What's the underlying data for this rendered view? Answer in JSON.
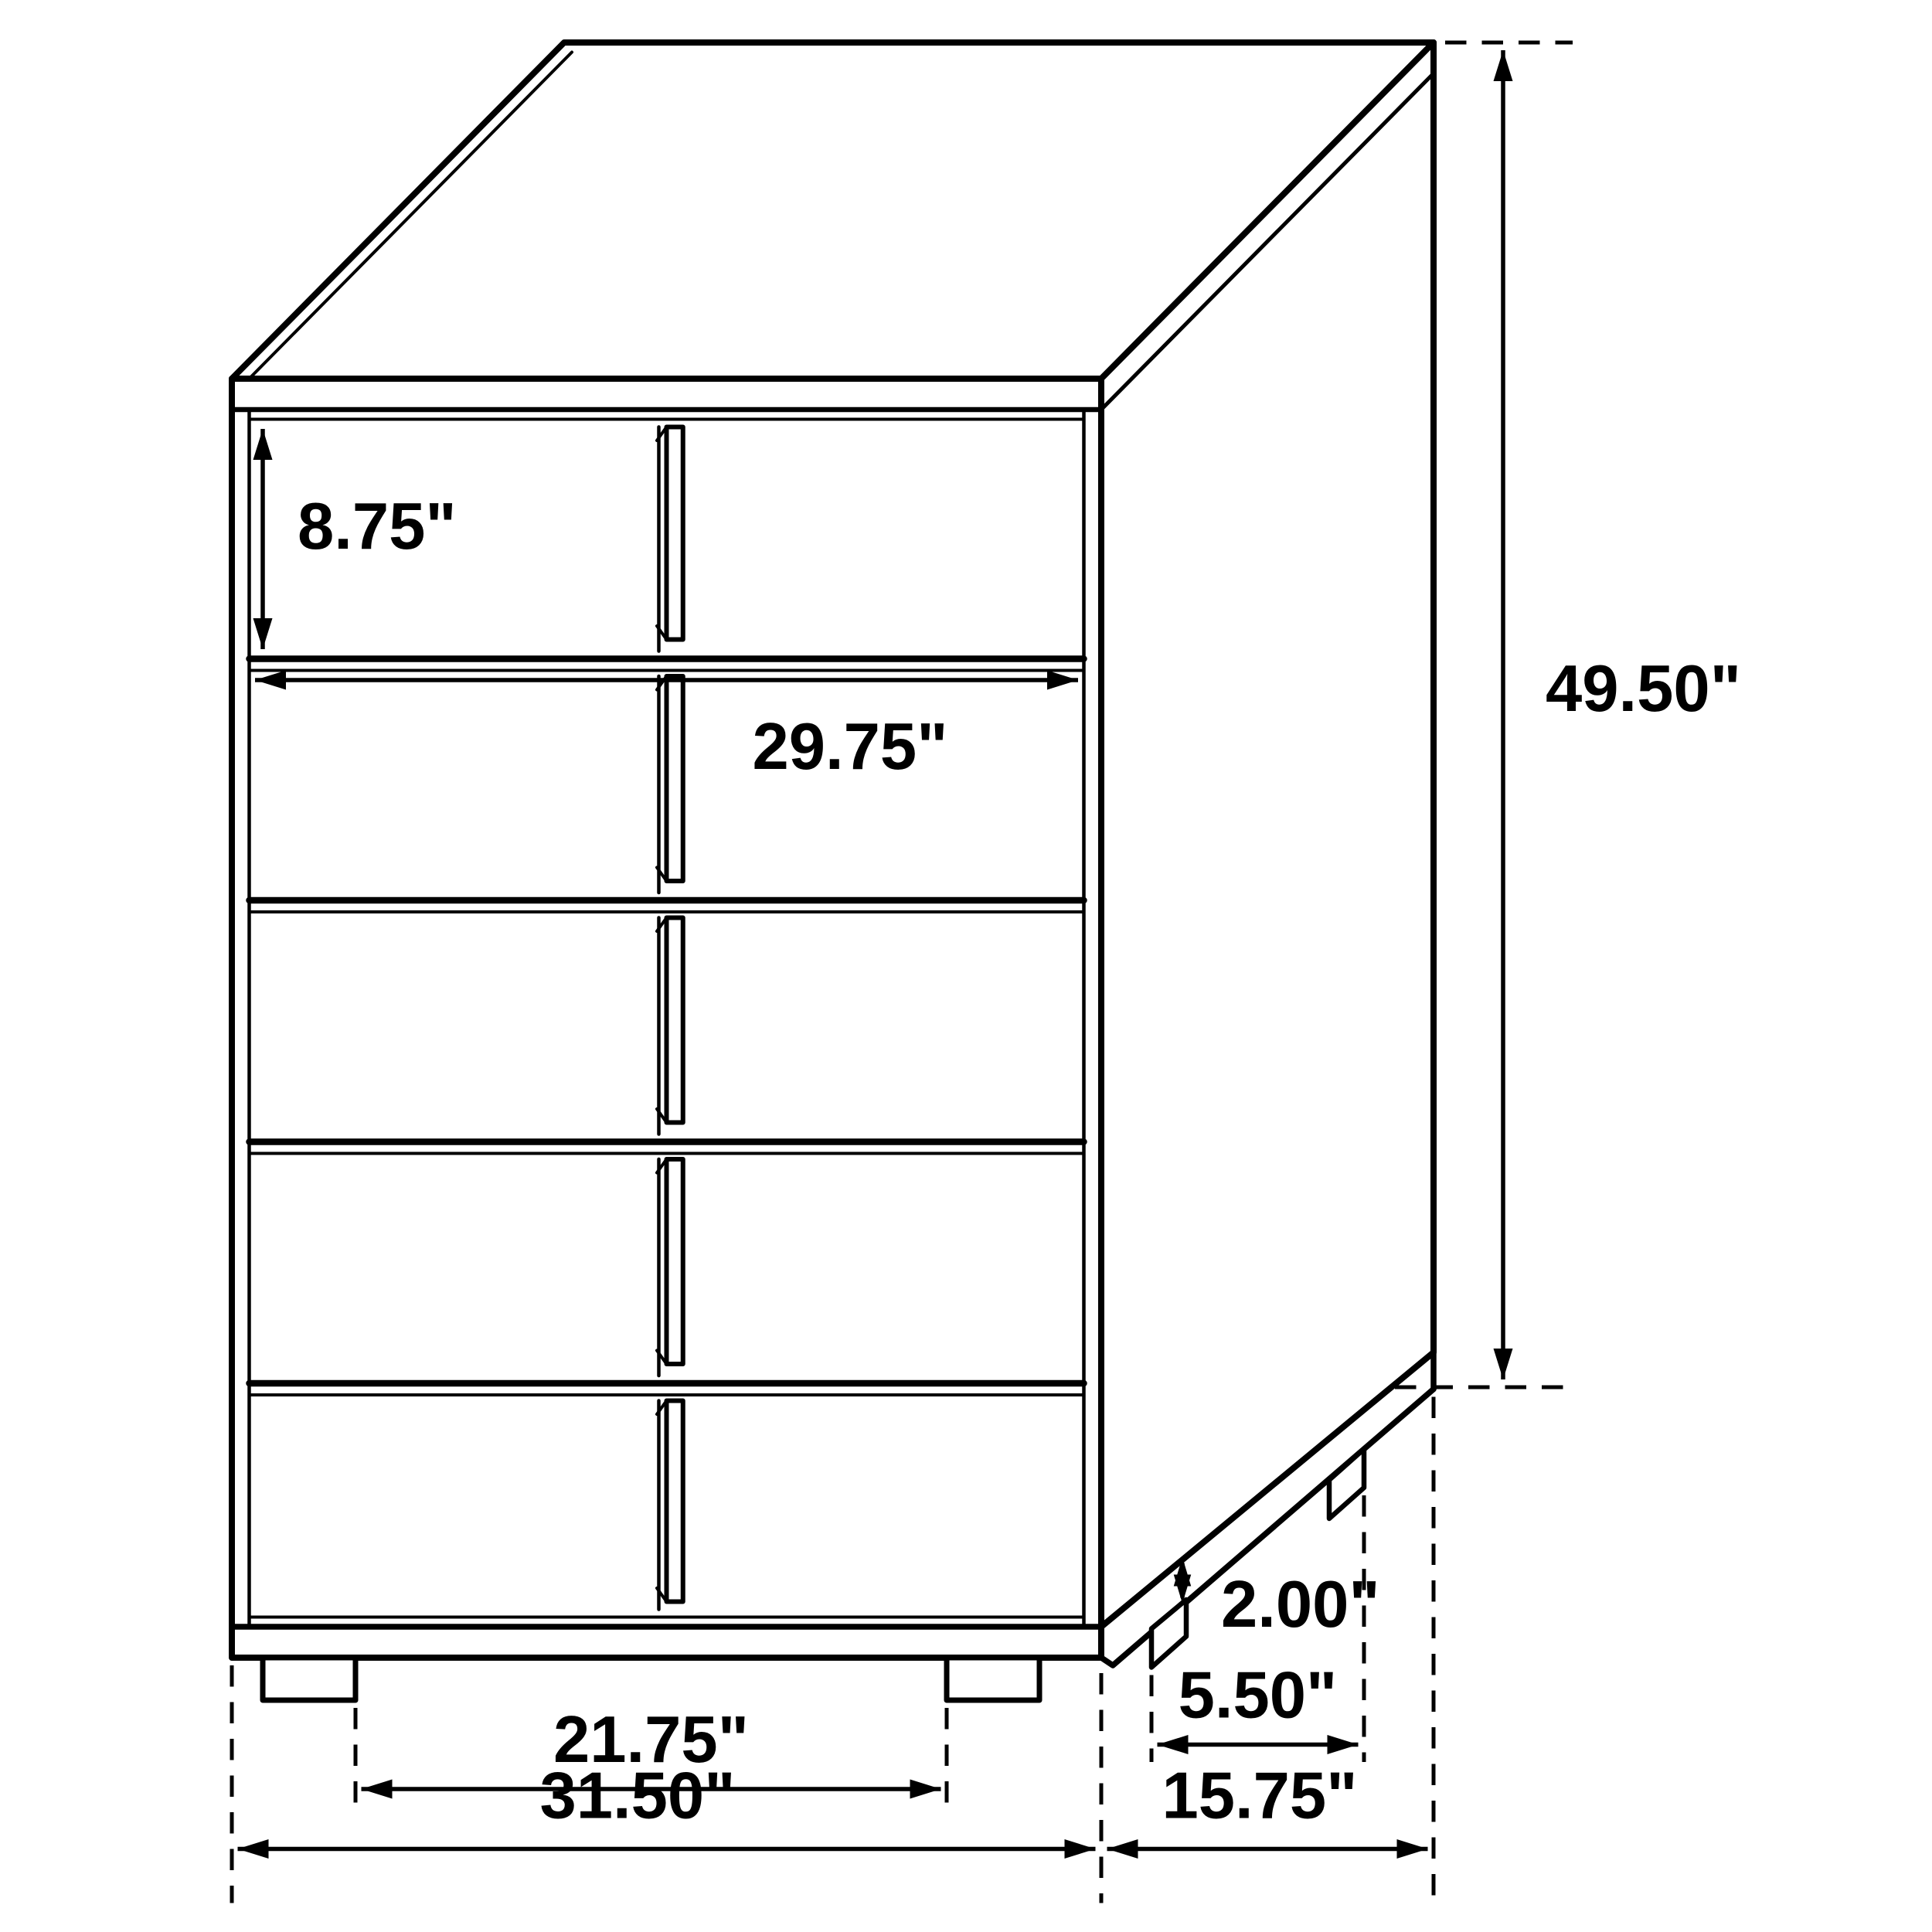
{
  "diagram": {
    "type": "furniture-dimension-line-drawing",
    "subject": "five-drawer-chest-oblique-view",
    "ink_color": "#000000",
    "background_color": "#ffffff",
    "units": "inches",
    "dimensions": {
      "top_drawer_height": "8.75\"",
      "drawer_width": "29.75\"",
      "overall_height": "49.50\"",
      "base_height": "2.00\"",
      "side_leg_spacing": "5.50\"",
      "front_leg_spacing": "21.75\"",
      "overall_width": "31.50\"",
      "overall_depth": "15.75\""
    }
  }
}
